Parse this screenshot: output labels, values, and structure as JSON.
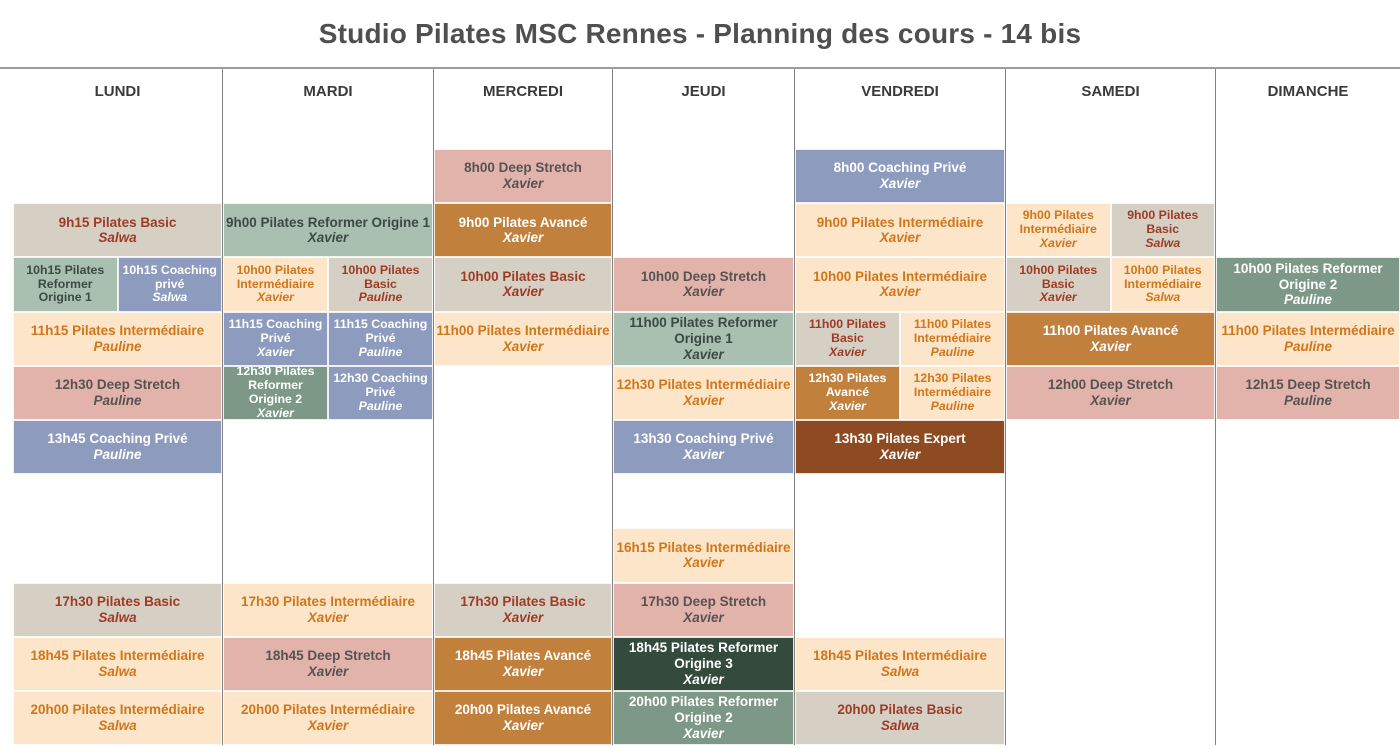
{
  "title": "Studio Pilates MSC Rennes - Planning des cours - 14 bis",
  "class_types": {
    "basic": {
      "label": "Pilates Basic",
      "bg": "#d6d0c4",
      "fg": "#9d3b25"
    },
    "intermediaire": {
      "label": "Pilates Intermédiaire",
      "bg": "#fce5c9",
      "fg": "#d0761b"
    },
    "avance": {
      "label": "Pilates Avancé",
      "bg": "#c2803d",
      "fg": "#ffffff"
    },
    "expert": {
      "label": "Pilates Expert",
      "bg": "#8e4a21",
      "fg": "#ffffff"
    },
    "deep": {
      "label": "Deep Stretch",
      "bg": "#e2b3ab",
      "fg": "#575350"
    },
    "coaching": {
      "label": "Coaching Privé",
      "bg": "#8d9cbe",
      "fg": "#ffffff"
    },
    "reformer1": {
      "label": "Pilates Reformer Origine 1",
      "bg": "#a9bfb0",
      "fg": "#3c4a44"
    },
    "reformer2": {
      "label": "Pilates Reformer Origine 2",
      "bg": "#7e9887",
      "fg": "#ffffff"
    },
    "reformer3": {
      "label": "Pilates Reformer Origine 3",
      "bg": "#344a3d",
      "fg": "#ffffff"
    }
  },
  "days": [
    {
      "label": "LUNDI",
      "blocks": [
        {
          "row": 1,
          "side": "full",
          "time": "9h15",
          "name": "Pilates Basic",
          "instructor": "Salwa",
          "type": "basic"
        },
        {
          "row": 2,
          "side": "left",
          "time": "10h15",
          "name": "Pilates Reformer Origine 1",
          "instructor": "",
          "type": "reformer1"
        },
        {
          "row": 2,
          "side": "right",
          "time": "10h15",
          "name": "Coaching privé",
          "instructor": "Salwa",
          "type": "coaching"
        },
        {
          "row": 3,
          "side": "full",
          "time": "11h15",
          "name": "Pilates Intermédiaire",
          "instructor": "Pauline",
          "type": "intermediaire"
        },
        {
          "row": 4,
          "side": "full",
          "time": "12h30",
          "name": "Deep Stretch",
          "instructor": "Pauline",
          "type": "deep"
        },
        {
          "row": 5,
          "side": "full",
          "time": "13h45",
          "name": "Coaching Privé",
          "instructor": "Pauline",
          "type": "coaching"
        },
        {
          "row": 8,
          "side": "full",
          "time": "17h30",
          "name": "Pilates Basic",
          "instructor": "Salwa",
          "type": "basic"
        },
        {
          "row": 9,
          "side": "full",
          "time": "18h45",
          "name": "Pilates Intermédiaire",
          "instructor": "Salwa",
          "type": "intermediaire"
        },
        {
          "row": 10,
          "side": "full",
          "time": "20h00",
          "name": "Pilates Intermédiaire",
          "instructor": "Salwa",
          "type": "intermediaire"
        }
      ]
    },
    {
      "label": "MARDI",
      "blocks": [
        {
          "row": 1,
          "side": "full",
          "time": "9h00",
          "name": "Pilates Reformer Origine 1",
          "instructor": "Xavier",
          "type": "reformer1"
        },
        {
          "row": 2,
          "side": "left",
          "time": "10h00",
          "name": "Pilates Intermédiaire",
          "instructor": "Xavier",
          "type": "intermediaire"
        },
        {
          "row": 2,
          "side": "right",
          "time": "10h00",
          "name": "Pilates Basic",
          "instructor": "Pauline",
          "type": "basic"
        },
        {
          "row": 3,
          "side": "left",
          "time": "11h15",
          "name": "Coaching Privé",
          "instructor": "Xavier",
          "type": "coaching"
        },
        {
          "row": 3,
          "side": "right",
          "time": "11h15",
          "name": "Coaching Privé",
          "instructor": "Pauline",
          "type": "coaching"
        },
        {
          "row": 4,
          "side": "left",
          "time": "12h30",
          "name": "Pilates Reformer Origine 2",
          "instructor": "Xavier",
          "type": "reformer2"
        },
        {
          "row": 4,
          "side": "right",
          "time": "12h30",
          "name": "Coaching Privé",
          "instructor": "Pauline",
          "type": "coaching"
        },
        {
          "row": 8,
          "side": "full",
          "time": "17h30",
          "name": "Pilates Intermédiaire",
          "instructor": "Xavier",
          "type": "intermediaire"
        },
        {
          "row": 9,
          "side": "full",
          "time": "18h45",
          "name": "Deep Stretch",
          "instructor": "Xavier",
          "type": "deep"
        },
        {
          "row": 10,
          "side": "full",
          "time": "20h00",
          "name": "Pilates Intermédiaire",
          "instructor": "Xavier",
          "type": "intermediaire"
        }
      ]
    },
    {
      "label": "MERCREDI",
      "blocks": [
        {
          "row": 0,
          "side": "full",
          "time": "8h00",
          "name": "Deep Stretch",
          "instructor": "Xavier",
          "type": "deep"
        },
        {
          "row": 1,
          "side": "full",
          "time": "9h00",
          "name": "Pilates Avancé",
          "instructor": "Xavier",
          "type": "avance"
        },
        {
          "row": 2,
          "side": "full",
          "time": "10h00",
          "name": "Pilates Basic",
          "instructor": "Xavier",
          "type": "basic"
        },
        {
          "row": 3,
          "side": "full",
          "time": "11h00",
          "name": "Pilates Intermédiaire",
          "instructor": "Xavier",
          "type": "intermediaire"
        },
        {
          "row": 8,
          "side": "full",
          "time": "17h30",
          "name": "Pilates Basic",
          "instructor": "Xavier",
          "type": "basic"
        },
        {
          "row": 9,
          "side": "full",
          "time": "18h45",
          "name": "Pilates Avancé",
          "instructor": "Xavier",
          "type": "avance"
        },
        {
          "row": 10,
          "side": "full",
          "time": "20h00",
          "name": "Pilates Avancé",
          "instructor": "Xavier",
          "type": "avance"
        }
      ]
    },
    {
      "label": "JEUDI",
      "blocks": [
        {
          "row": 2,
          "side": "full",
          "time": "10h00",
          "name": "Deep Stretch",
          "instructor": "Xavier",
          "type": "deep"
        },
        {
          "row": 3,
          "side": "full",
          "time": "11h00",
          "name": "Pilates Reformer Origine 1",
          "instructor": "Xavier",
          "type": "reformer1"
        },
        {
          "row": 4,
          "side": "full",
          "time": "12h30",
          "name": "Pilates Intermédiaire",
          "instructor": "Xavier",
          "type": "intermediaire"
        },
        {
          "row": 5,
          "side": "full",
          "time": "13h30",
          "name": "Coaching Privé",
          "instructor": "Xavier",
          "type": "coaching"
        },
        {
          "row": 7,
          "side": "full",
          "time": "16h15",
          "name": "Pilates Intermédiaire",
          "instructor": "Xavier",
          "type": "intermediaire"
        },
        {
          "row": 8,
          "side": "full",
          "time": "17h30",
          "name": "Deep Stretch",
          "instructor": "Xavier",
          "type": "deep"
        },
        {
          "row": 9,
          "side": "full",
          "time": "18h45",
          "name": "Pilates Reformer Origine 3",
          "instructor": "Xavier",
          "type": "reformer3"
        },
        {
          "row": 10,
          "side": "full",
          "time": "20h00",
          "name": "Pilates Reformer Origine 2",
          "instructor": "Xavier",
          "type": "reformer2"
        }
      ]
    },
    {
      "label": "VENDREDI",
      "blocks": [
        {
          "row": 0,
          "side": "full",
          "time": "8h00",
          "name": "Coaching Privé",
          "instructor": "Xavier",
          "type": "coaching"
        },
        {
          "row": 1,
          "side": "full",
          "time": "9h00",
          "name": "Pilates Intermédiaire",
          "instructor": "Xavier",
          "type": "intermediaire"
        },
        {
          "row": 2,
          "side": "full",
          "time": "10h00",
          "name": "Pilates Intermédiaire",
          "instructor": "Xavier",
          "type": "intermediaire"
        },
        {
          "row": 3,
          "side": "left",
          "time": "11h00",
          "name": "Pilates Basic",
          "instructor": "Xavier",
          "type": "basic"
        },
        {
          "row": 3,
          "side": "right",
          "time": "11h00",
          "name": "Pilates Intermédiaire",
          "instructor": "Pauline",
          "type": "intermediaire"
        },
        {
          "row": 4,
          "side": "left",
          "time": "12h30",
          "name": "Pilates Avancé",
          "instructor": "Xavier",
          "type": "avance"
        },
        {
          "row": 4,
          "side": "right",
          "time": "12h30",
          "name": "Pilates Intermédiaire",
          "instructor": "Pauline",
          "type": "intermediaire"
        },
        {
          "row": 5,
          "side": "full",
          "time": "13h30",
          "name": "Pilates Expert",
          "instructor": "Xavier",
          "type": "expert"
        },
        {
          "row": 9,
          "side": "full",
          "time": "18h45",
          "name": "Pilates Intermédiaire",
          "instructor": "Salwa",
          "type": "intermediaire"
        },
        {
          "row": 10,
          "side": "full",
          "time": "20h00",
          "name": "Pilates Basic",
          "instructor": "Salwa",
          "type": "basic"
        }
      ]
    },
    {
      "label": "SAMEDI",
      "blocks": [
        {
          "row": 1,
          "side": "left",
          "time": "9h00",
          "name": "Pilates Intermédiaire",
          "instructor": "Xavier",
          "type": "intermediaire"
        },
        {
          "row": 1,
          "side": "right",
          "time": "9h00",
          "name": "Pilates Basic",
          "instructor": "Salwa",
          "type": "basic"
        },
        {
          "row": 2,
          "side": "left",
          "time": "10h00",
          "name": "Pilates Basic",
          "instructor": "Xavier",
          "type": "basic"
        },
        {
          "row": 2,
          "side": "right",
          "time": "10h00",
          "name": "Pilates Intermédiaire",
          "instructor": "Salwa",
          "type": "intermediaire"
        },
        {
          "row": 3,
          "side": "full",
          "time": "11h00",
          "name": "Pilates Avancé",
          "instructor": "Xavier",
          "type": "avance"
        },
        {
          "row": 4,
          "side": "full",
          "time": "12h00",
          "name": "Deep Stretch",
          "instructor": "Xavier",
          "type": "deep"
        }
      ]
    },
    {
      "label": "DIMANCHE",
      "blocks": [
        {
          "row": 2,
          "side": "full",
          "time": "10h00",
          "name": "Pilates Reformer Origine 2",
          "instructor": "Pauline",
          "type": "reformer2"
        },
        {
          "row": 3,
          "side": "full",
          "time": "11h00",
          "name": "Pilates Intermédiaire",
          "instructor": "Pauline",
          "type": "intermediaire"
        },
        {
          "row": 4,
          "side": "full",
          "time": "12h15",
          "name": "Deep Stretch",
          "instructor": "Pauline",
          "type": "deep"
        }
      ]
    }
  ]
}
